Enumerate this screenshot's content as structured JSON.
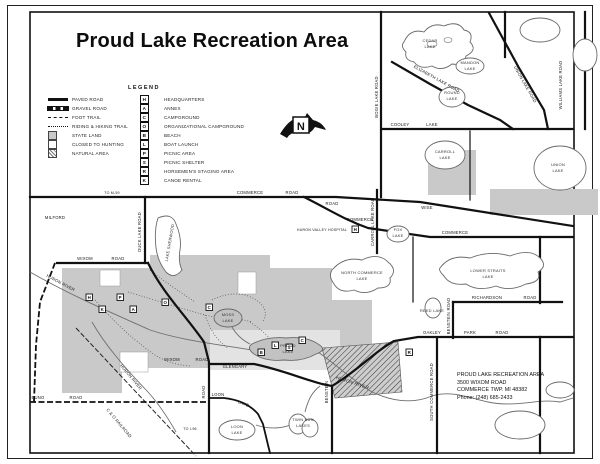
{
  "title": "Proud Lake Recreation Area",
  "legend": {
    "heading": "LEGEND",
    "line_items": [
      {
        "label": "PAVED ROAD",
        "style": "paved"
      },
      {
        "label": "GRAVEL ROAD",
        "style": "gravel"
      },
      {
        "label": "FOOT TRAIL",
        "style": "foot"
      },
      {
        "label": "RIDING & HIKING TRAIL",
        "style": "riding"
      },
      {
        "label": "STATE LAND",
        "style": "state"
      },
      {
        "label": "CLOSED TO HUNTING",
        "style": "closed"
      },
      {
        "label": "NATURAL AREA",
        "style": "natural"
      }
    ],
    "facility_items": [
      {
        "symbol": "H",
        "label": "HEADQUARTERS"
      },
      {
        "symbol": "A",
        "label": "ANNEX"
      },
      {
        "symbol": "C",
        "label": "CAMPGROUND"
      },
      {
        "symbol": "O",
        "label": "ORGANIZATIONAL CAMPGROUND"
      },
      {
        "symbol": "B",
        "label": "BEACH"
      },
      {
        "symbol": "L",
        "label": "BOAT LAUNCH"
      },
      {
        "symbol": "P",
        "label": "PICNIC AREA"
      },
      {
        "symbol": "S",
        "label": "PICNIC SHELTER"
      },
      {
        "symbol": "R",
        "label": "HORSEMEN'S STAGING AREA"
      },
      {
        "symbol": "K",
        "label": "CANOE RENTAL"
      }
    ]
  },
  "north_arrow": {
    "label": "N"
  },
  "contact": {
    "lines": [
      "PROUD LAKE RECREATION AREA",
      "3500 WIXOM ROAD",
      "COMMERCE TWP. MI 48382",
      "Phone: (248) 685-2433"
    ]
  },
  "map": {
    "labels": [
      {
        "t": "MILFORD",
        "x": 55,
        "y": 219
      },
      {
        "t": "TO M-59",
        "x": 112,
        "y": 194,
        "s": "sm"
      },
      {
        "t": "DUCK LAKE ROAD",
        "x": 141,
        "y": 232,
        "r": -90
      },
      {
        "t": "LAKE SHERWOOD",
        "x": 171,
        "y": 243,
        "r": -80,
        "s": "lake"
      },
      {
        "t": "WIXOM",
        "x": 85,
        "y": 260
      },
      {
        "t": "ROAD",
        "x": 118,
        "y": 260
      },
      {
        "t": "HURON RIVER",
        "x": 60,
        "y": 284,
        "r": 28
      },
      {
        "t": "COMMERCE",
        "x": 250,
        "y": 194
      },
      {
        "t": "ROAD",
        "x": 292,
        "y": 194
      },
      {
        "t": "COOLEY",
        "x": 400,
        "y": 126
      },
      {
        "t": "LAKE",
        "x": 432,
        "y": 126
      },
      {
        "t": "BOGIE LAKE ROAD",
        "x": 378,
        "y": 97,
        "r": -90
      },
      {
        "t": "ELIZABETH LAKE ROAD",
        "x": 436,
        "y": 80,
        "r": 29
      },
      {
        "t": "UNION LAKE ROAD",
        "x": 524,
        "y": 85,
        "r": 60
      },
      {
        "t": "WILLIAMS LAKE ROAD",
        "x": 562,
        "y": 85,
        "r": -90
      },
      {
        "t": "CEDAR",
        "x": 430,
        "y": 42,
        "s": "lake"
      },
      {
        "t": "LAKE",
        "x": 430,
        "y": 48,
        "s": "lake"
      },
      {
        "t": "MANDON",
        "x": 470,
        "y": 64,
        "s": "lake"
      },
      {
        "t": "LAKE",
        "x": 470,
        "y": 70,
        "s": "lake"
      },
      {
        "t": "ROUND",
        "x": 452,
        "y": 94,
        "s": "lake"
      },
      {
        "t": "LAKE",
        "x": 452,
        "y": 100,
        "s": "lake"
      },
      {
        "t": "CARROLL",
        "x": 445,
        "y": 153,
        "s": "lake"
      },
      {
        "t": "LAKE",
        "x": 445,
        "y": 159,
        "s": "lake"
      },
      {
        "t": "FOX",
        "x": 398,
        "y": 231,
        "s": "lake"
      },
      {
        "t": "LAKE",
        "x": 398,
        "y": 237,
        "s": "lake"
      },
      {
        "t": "UNION",
        "x": 558,
        "y": 166,
        "s": "lake"
      },
      {
        "t": "LAKE",
        "x": 558,
        "y": 172,
        "s": "lake"
      },
      {
        "t": "ROAD",
        "x": 332,
        "y": 205
      },
      {
        "t": "WISE",
        "x": 427,
        "y": 209
      },
      {
        "t": "COMMERCE",
        "x": 360,
        "y": 221
      },
      {
        "t": "HURON VALLEY HOSPITAL",
        "x": 322,
        "y": 231,
        "s": "sm"
      },
      {
        "t": "COMMERCE",
        "x": 455,
        "y": 234
      },
      {
        "t": "CARROLL LAKE ROAD",
        "x": 374,
        "y": 222,
        "r": -90
      },
      {
        "t": "NORTH COMMERCE",
        "x": 362,
        "y": 274,
        "s": "lake"
      },
      {
        "t": "LAKE",
        "x": 362,
        "y": 280,
        "s": "lake"
      },
      {
        "t": "LOWER STRAITS",
        "x": 488,
        "y": 272,
        "s": "lake"
      },
      {
        "t": "LAKE",
        "x": 488,
        "y": 278,
        "s": "lake"
      },
      {
        "t": "REED LAKE",
        "x": 432,
        "y": 312,
        "s": "lake"
      },
      {
        "t": "RICHARDSON",
        "x": 487,
        "y": 299
      },
      {
        "t": "ROAD",
        "x": 530,
        "y": 299
      },
      {
        "t": "BENSTEIN ROAD",
        "x": 450,
        "y": 316,
        "r": -90
      },
      {
        "t": "SOUTH COMMERCE ROAD",
        "x": 433,
        "y": 392,
        "r": -90
      },
      {
        "t": "BENSTEIN",
        "x": 328,
        "y": 392,
        "r": -90
      },
      {
        "t": "OAKLEY",
        "x": 432,
        "y": 334
      },
      {
        "t": "PARK",
        "x": 470,
        "y": 334
      },
      {
        "t": "ROAD",
        "x": 502,
        "y": 334
      },
      {
        "t": "MOSS",
        "x": 228,
        "y": 316,
        "s": "lake"
      },
      {
        "t": "LAKE",
        "x": 228,
        "y": 322,
        "s": "lake"
      },
      {
        "t": "PROUD",
        "x": 288,
        "y": 347,
        "s": "lake"
      },
      {
        "t": "LAKE",
        "x": 288,
        "y": 353,
        "s": "lake"
      },
      {
        "t": "WIXOM",
        "x": 172,
        "y": 361
      },
      {
        "t": "ROAD",
        "x": 202,
        "y": 361
      },
      {
        "t": "GLENGARY",
        "x": 235,
        "y": 368
      },
      {
        "t": "ROAD",
        "x": 205,
        "y": 392,
        "r": -90
      },
      {
        "t": "TO I-96",
        "x": 190,
        "y": 430,
        "s": "sm"
      },
      {
        "t": "LOON",
        "x": 218,
        "y": 396
      },
      {
        "t": "LAKE",
        "x": 243,
        "y": 405,
        "r": 20
      },
      {
        "t": "LOON",
        "x": 237,
        "y": 428,
        "s": "lake"
      },
      {
        "t": "LAKE",
        "x": 237,
        "y": 434,
        "s": "lake"
      },
      {
        "t": "TWIN SUN",
        "x": 303,
        "y": 421,
        "s": "lake"
      },
      {
        "t": "LAKES",
        "x": 303,
        "y": 427,
        "s": "lake"
      },
      {
        "t": "BUNO",
        "x": 38,
        "y": 399
      },
      {
        "t": "ROAD",
        "x": 76,
        "y": 399
      },
      {
        "t": "C & O RAILROAD",
        "x": 118,
        "y": 424,
        "r": 50
      },
      {
        "t": "HURON RIVER",
        "x": 130,
        "y": 378,
        "r": 50
      },
      {
        "t": "HURON RIVER",
        "x": 352,
        "y": 384,
        "r": 18,
        "s": "script"
      }
    ],
    "icons": [
      {
        "symbol": "H",
        "x": 86,
        "y": 294
      },
      {
        "symbol": "K",
        "x": 99,
        "y": 306
      },
      {
        "symbol": "P",
        "x": 117,
        "y": 294
      },
      {
        "symbol": "A",
        "x": 130,
        "y": 306
      },
      {
        "symbol": "O",
        "x": 162,
        "y": 299
      },
      {
        "symbol": "C",
        "x": 206,
        "y": 304
      },
      {
        "symbol": "B",
        "x": 258,
        "y": 349
      },
      {
        "symbol": "L",
        "x": 272,
        "y": 342
      },
      {
        "symbol": "S",
        "x": 286,
        "y": 344
      },
      {
        "symbol": "C",
        "x": 299,
        "y": 337
      },
      {
        "symbol": "R",
        "x": 406,
        "y": 349
      },
      {
        "symbol": "H",
        "x": 352,
        "y": 226
      }
    ]
  }
}
